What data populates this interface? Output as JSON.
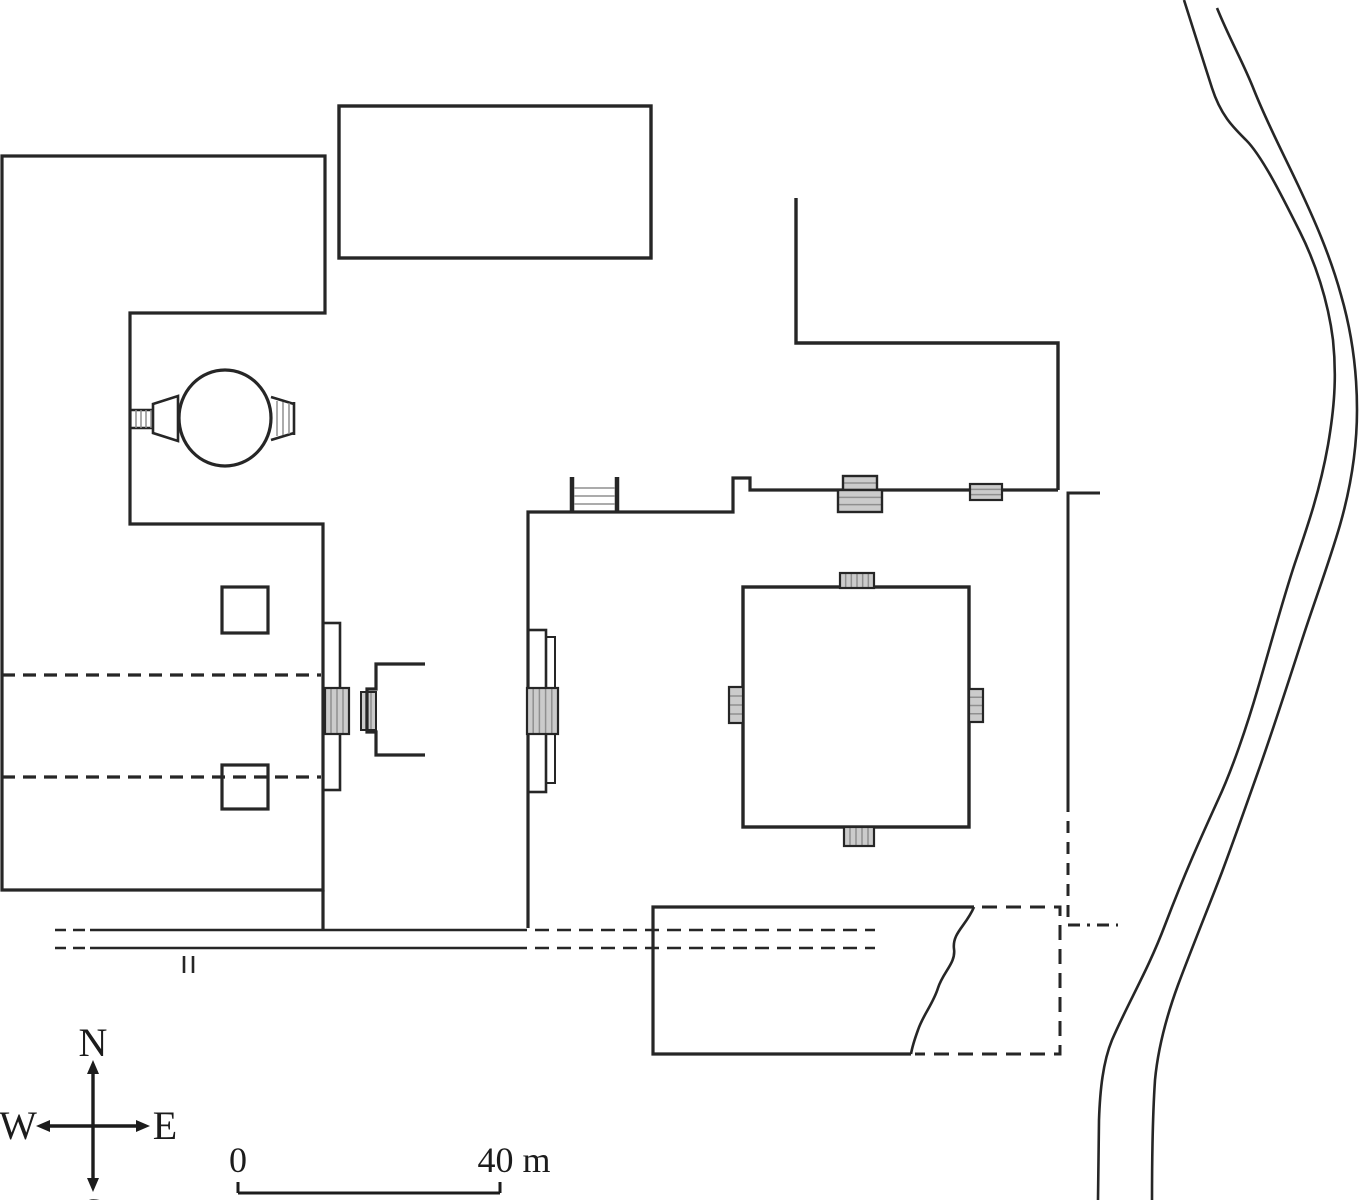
{
  "plan": {
    "colors": {
      "ink": "#262626",
      "stair_fill": "#cbcbcb",
      "stair_line": "#8f8f8f",
      "background": "#ffffff"
    },
    "compass": {
      "north": "N",
      "south": "S",
      "east": "E",
      "west": "W"
    },
    "scalebar": {
      "start_label": "0",
      "end_label": "40 m"
    },
    "features": [
      {
        "name": "west-building-outline",
        "type": "path",
        "d": "M2,156 H325 V313 H130 V524 H323 V890 H2 Z",
        "w": 3.2
      },
      {
        "name": "west-building-wall-to-road",
        "type": "path",
        "d": "M323,890 V931",
        "w": 3.2
      },
      {
        "name": "north-hall",
        "type": "rect",
        "x": 339,
        "y": 106,
        "w": 312,
        "h": 152,
        "sw": 3.4
      },
      {
        "name": "northeast-courtyard-wall",
        "type": "path",
        "d": "M796,198 V343 H1058 V490",
        "w": 3.4
      },
      {
        "name": "middle-enclosure-wall",
        "type": "path",
        "d": "M528,928 V512 H733 V478 H750 V490 H1058",
        "w": 3.2
      },
      {
        "name": "east-annex-wall-solid",
        "type": "path",
        "d": "M1100,493 H1068 V800",
        "w": 3
      },
      {
        "name": "east-annex-wall-dashed",
        "type": "path",
        "d": "M1068,800 V925",
        "w": 3,
        "dash": "12 9"
      },
      {
        "name": "east-annex-wall-dashdot",
        "type": "path",
        "d": "M1068,925 H1118",
        "w": 3,
        "dash": "12 7 3 7"
      },
      {
        "name": "enclosure-north-stair-sides",
        "type": "path",
        "d": "M572,477 V512 M617,477 V512",
        "w": 4.5
      },
      {
        "name": "enclosure-north-stair-rungs",
        "type": "path",
        "d": "M574,488 H615 M574,496 H615 M574,504 H615",
        "w": 1.5,
        "color": "#8f8f8f"
      },
      {
        "name": "north-gate-stair-upper",
        "type": "hatch",
        "x": 843,
        "y": 476,
        "w": 34,
        "h": 14,
        "dir": "h",
        "n": 1,
        "sw": 2.4
      },
      {
        "name": "north-gate-stair-lower",
        "type": "hatch",
        "x": 838,
        "y": 490,
        "w": 44,
        "h": 22,
        "dir": "h",
        "n": 2,
        "sw": 2.4
      },
      {
        "name": "north-wall-threshold-pad",
        "type": "hatch",
        "x": 970,
        "y": 484,
        "w": 32,
        "h": 16,
        "dir": "h",
        "n": 2,
        "sw": 2.2
      },
      {
        "name": "main-shrine",
        "type": "rect",
        "x": 743,
        "y": 587,
        "w": 226,
        "h": 240,
        "sw": 3.4
      },
      {
        "name": "main-shrine-stair-north",
        "type": "hatch",
        "x": 840,
        "y": 573,
        "w": 34,
        "h": 15,
        "dir": "v",
        "n": 5,
        "sw": 2.2
      },
      {
        "name": "main-shrine-stair-south",
        "type": "hatch",
        "x": 844,
        "y": 827,
        "w": 30,
        "h": 19,
        "dir": "v",
        "n": 4,
        "sw": 2.2
      },
      {
        "name": "main-shrine-stair-west",
        "type": "hatch",
        "x": 729,
        "y": 687,
        "w": 14,
        "h": 36,
        "dir": "h",
        "n": 3,
        "sw": 2.2
      },
      {
        "name": "main-shrine-stair-east",
        "type": "hatch",
        "x": 969,
        "y": 689,
        "w": 14,
        "h": 33,
        "dir": "h",
        "n": 3,
        "sw": 2.2
      },
      {
        "name": "west-gate-pilaster",
        "type": "rect",
        "x": 323,
        "y": 623,
        "w": 17,
        "h": 167,
        "sw": 2.6
      },
      {
        "name": "west-gate-stair-block",
        "type": "hatch",
        "x": 325,
        "y": 688,
        "w": 24,
        "h": 46,
        "dir": "v",
        "n": 3,
        "sw": 2.2
      },
      {
        "name": "gateway-step-block",
        "type": "hatch",
        "x": 361,
        "y": 692,
        "w": 15,
        "h": 38,
        "dir": "v",
        "n": 2,
        "sw": 2
      },
      {
        "name": "gateway-porch",
        "type": "path",
        "d": "M425,664 H376 V689 H367 V732 H376 V755 H425",
        "w": 3.2
      },
      {
        "name": "east-gate-pilaster-outer",
        "type": "rect",
        "x": 528,
        "y": 630,
        "w": 18,
        "h": 162,
        "sw": 2.6
      },
      {
        "name": "east-gate-pilaster-inner",
        "type": "rect",
        "x": 546,
        "y": 637,
        "w": 9,
        "h": 146,
        "sw": 2
      },
      {
        "name": "east-gate-stair-block",
        "type": "hatch",
        "x": 527,
        "y": 688,
        "w": 31,
        "h": 46,
        "dir": "v",
        "n": 4,
        "sw": 2.2
      },
      {
        "name": "circular-shrine",
        "type": "ellipse",
        "cx": 225,
        "cy": 418,
        "rx": 46,
        "ry": 48,
        "sw": 3.2
      },
      {
        "name": "circular-shrine-west-passage-walls",
        "type": "path",
        "d": "M131,410 H153 M131,428 H153",
        "w": 2.6
      },
      {
        "name": "circular-shrine-west-passage-steps",
        "type": "path",
        "d": "M136,410 V428 M141,410 V428 M146,410 V428 M151,410 V428",
        "w": 1.5,
        "color": "#8f8f8f"
      },
      {
        "name": "circular-shrine-west-porch",
        "type": "path",
        "d": "M153,404 L178,396 L178,441 L153,433 Z",
        "w": 2.6,
        "fill": "#ffffff"
      },
      {
        "name": "circular-shrine-east-stair-walls",
        "type": "path",
        "d": "M271,397 L294,404 M271,440 L294,433 M294,402 V435",
        "w": 2.6
      },
      {
        "name": "circular-shrine-east-stair-steps",
        "type": "path",
        "d": "M277,401 V436 M283,402 V435 M289,403 V434",
        "w": 1.5,
        "color": "#8f8f8f"
      },
      {
        "name": "west-building-dashed-axis-north",
        "type": "path",
        "d": "M2,675 H321",
        "w": 3.2,
        "dash": "13 8"
      },
      {
        "name": "west-building-dashed-axis-south",
        "type": "path",
        "d": "M2,777 H321",
        "w": 3.2,
        "dash": "13 8"
      },
      {
        "name": "west-building-pillar-north",
        "type": "rect",
        "x": 222,
        "y": 587,
        "w": 46,
        "h": 46,
        "sw": 3.2
      },
      {
        "name": "west-building-pillar-south",
        "type": "rect",
        "x": 222,
        "y": 765,
        "w": 46,
        "h": 44,
        "sw": 3.2
      },
      {
        "name": "road-north-line",
        "type": "path",
        "d": "M55,930 H66 M73,930 H85 M90,930 H527",
        "w": 2.6
      },
      {
        "name": "road-north-line-dashed",
        "type": "path",
        "d": "M535,930 H875",
        "w": 2.6,
        "dash": "14 8"
      },
      {
        "name": "road-south-line",
        "type": "path",
        "d": "M55,948 H66 M73,948 H85 M90,948 H527",
        "w": 2.6
      },
      {
        "name": "road-south-line-dashed",
        "type": "path",
        "d": "M535,948 H875",
        "w": 2.6,
        "dash": "14 8"
      },
      {
        "name": "road-tick-marks",
        "type": "path",
        "d": "M184,956 V973 M193,956 V973",
        "w": 2.6
      },
      {
        "name": "south-building-solid-walls",
        "type": "path",
        "d": "M974,907 H653 V1054 H911",
        "w": 3.2
      },
      {
        "name": "south-building-dashed-walls",
        "type": "path",
        "d": "M982,907 H1060 V1054 H915",
        "w": 3,
        "dash": "15 9"
      },
      {
        "name": "south-building-break-line",
        "type": "path",
        "d": "M974,907 C966,926 952,933 954,949 C956,963 943,972 938,988 C933,1004 923,1015 918,1030 C914,1041 912,1048 911,1054",
        "w": 2.6
      },
      {
        "name": "river-west-bank",
        "type": "path",
        "d": "M1184,0 C1195,35 1203,60 1212,88 C1221,116 1234,128 1246,140 C1262,156 1282,196 1300,232 C1315,262 1328,300 1333,340 C1337,378 1334,410 1328,445 C1320,490 1308,525 1296,560 C1285,592 1272,640 1258,688 C1247,726 1232,770 1218,800 C1203,833 1186,870 1165,925 C1148,970 1128,1003 1112,1040 C1103,1062 1100,1090 1099,1120 L1098,1200",
        "w": 2.6
      },
      {
        "name": "river-east-bank",
        "type": "path",
        "d": "M1217,8 C1230,40 1243,62 1254,90 C1268,125 1284,155 1298,185 C1314,219 1330,255 1341,295 C1352,333 1357,370 1357,410 C1357,450 1350,490 1340,525 C1329,563 1315,600 1302,640 C1288,683 1272,733 1258,772 C1247,803 1234,840 1222,872 C1209,906 1193,945 1178,985 C1167,1015 1158,1048 1155,1080 C1153,1110 1152,1150 1152,1200",
        "w": 2.6
      }
    ]
  }
}
